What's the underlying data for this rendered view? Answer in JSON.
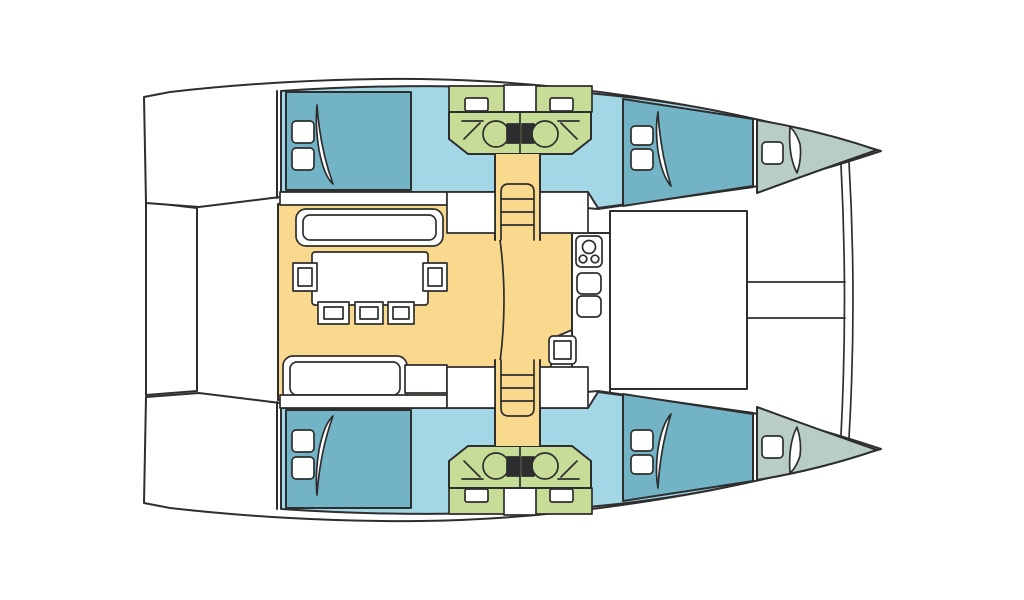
{
  "diagram": {
    "kind": "catamaran-deck-plan",
    "view": "top-down floor plan, bows to the right, sterns to the left",
    "visible_text": "none"
  },
  "colors": {
    "background": "#ffffff",
    "outline": "#2e2e2e",
    "hull_interior": "#a4d7e6",
    "bed": "#72b4c6",
    "forepeak": "#b9cdc8",
    "salon": "#f8d98d",
    "bathroom": "#c7dc97",
    "white": "#ffffff"
  },
  "areas": {
    "aft_cabin": "double berth cabin at stern of each hull",
    "forward_cabin": "double berth cabin at bow of each hull",
    "bathroom": "two mirrored wet rooms with sink, toilet and shower per hull",
    "salon": "central saloon with dining table, chairs and settees",
    "galley": "counter with stove, cabinets and sink",
    "cockpit": "central cockpit between hulls",
    "forepeak": "bow storage locker with hatch",
    "aft_platform": "stern boarding platform",
    "trampoline": "forward area between bows with crossbeam and bowsprit"
  }
}
